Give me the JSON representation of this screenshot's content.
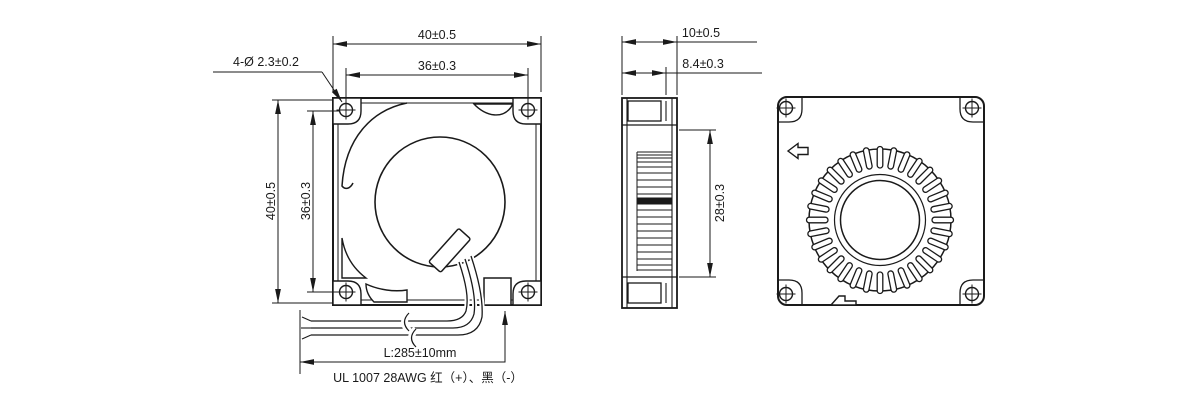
{
  "drawing": {
    "title": "blower-fan-3-view-dimension-drawing",
    "colors": {
      "line": "#1a1a1a",
      "background": "#ffffff"
    },
    "labels": {
      "front_width": "40±0.5",
      "front_hole_span_h": "36±0.3",
      "front_height": "40±0.5",
      "front_hole_span_v": "36±0.3",
      "mounting_holes": "4-Ø 2.3±0.2",
      "depth": "10±0.5",
      "inner_depth": "8.4±0.3",
      "vent_height": "28±0.3",
      "lead_wire_length": "L:285±10mm",
      "wire_spec": "UL 1007 28AWG 红（+）、黑（-）"
    }
  }
}
